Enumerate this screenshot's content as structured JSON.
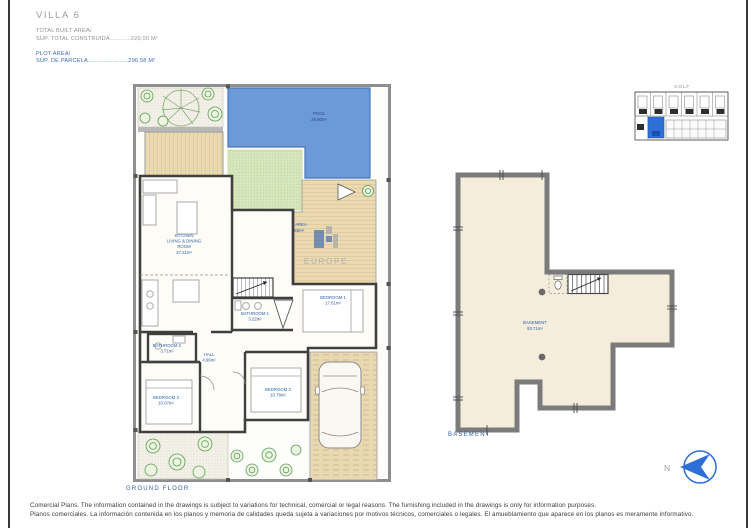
{
  "header": {
    "title": "VILLA 6",
    "built_label": "TOTAL BUILT AREA/",
    "built_value": "SUP. TOTAL CONSTRUIDA............220,00 M²",
    "plot_label": "PLOT AREA/",
    "plot_value": "SUP. DE PARCELA.......................296,58 M²"
  },
  "key_map": {
    "title": "GOLF",
    "accent_color": "#2e6fd6"
  },
  "watermark": {
    "text": "EUROPE"
  },
  "ground_floor": {
    "caption": "GROUND FLOOR",
    "pool": {
      "name": "POOL",
      "area": "29.80m²"
    },
    "plot": {
      "name": "PLOT AREA",
      "area": "296.58m²"
    },
    "kitchen": {
      "line1": "KITCHEN",
      "line2": "LIVING & DINING",
      "line3": "ROOM",
      "area": "37.21m²"
    },
    "bathroom1": {
      "name": "BATHROOM 1",
      "area": "3.22m²"
    },
    "bedroom1": {
      "name": "BEDROOM 1",
      "area": "17.61m²"
    },
    "bathroom2": {
      "name": "BATHROOM 2",
      "area": "3.71m²"
    },
    "hall": {
      "name": "HALL",
      "area": "4.96m²"
    },
    "bedroom2": {
      "name": "BEDROOM 2",
      "area": "10.78m²"
    },
    "bedroom3": {
      "name": "BEDROOM 3",
      "area": "10.07m²"
    }
  },
  "basement": {
    "caption": "BASEMENT",
    "label": "BASEMENT",
    "area": "93.71m²"
  },
  "compass": {
    "north": "N"
  },
  "footer": {
    "line1": "Comercial Plans. The information contained in the drawings is subject to variations for technical, comercial or legal reasons. The furnishing included in the drawings is only for information purposes.",
    "line2": "Planos comerciales. La información contenida en los planos y memoria de calidades queda sujeta a variaciones por motivos técnicos, comerciales o legales. El amueblamiento que aparece en los planos es meramente informativo."
  },
  "colors": {
    "pool": "#6d99d8",
    "deck": "#ead9b1",
    "grass": "#d7e6bd",
    "floor": "#f4eddc",
    "label_blue": "#2f62ae"
  }
}
